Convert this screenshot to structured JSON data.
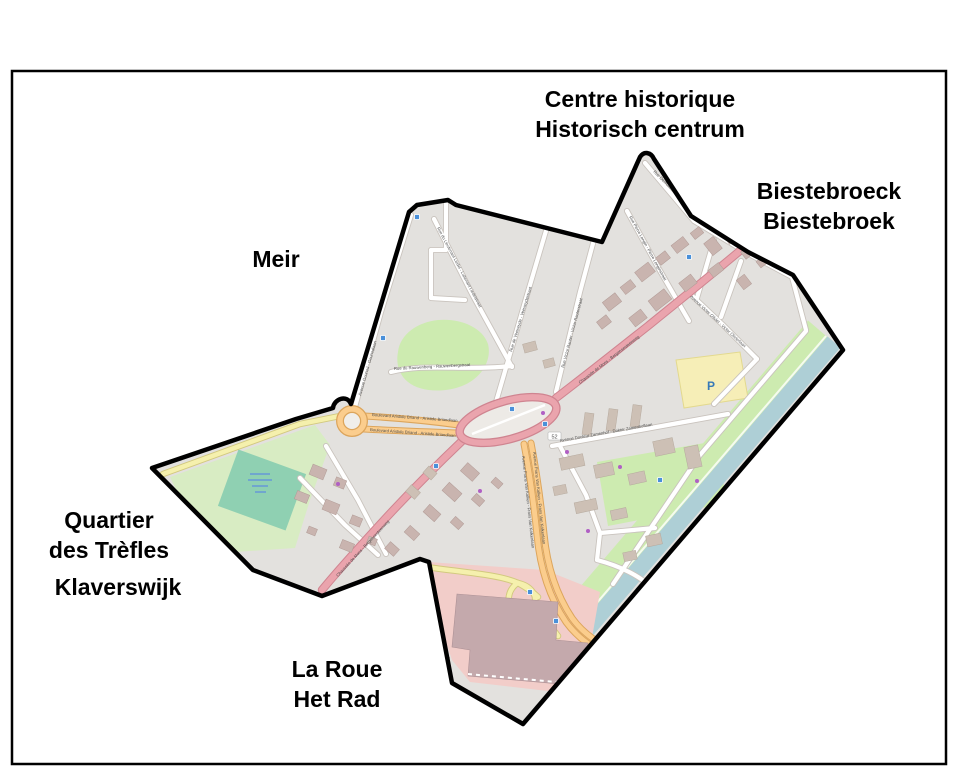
{
  "figure": {
    "type": "district-map",
    "background": "#ffffff",
    "frame_color": "#000000",
    "boundary_color": "#000000"
  },
  "region_labels": {
    "centre_historique": {
      "line1": "Centre historique",
      "line2": "Historisch centrum"
    },
    "biestebroeck": {
      "line1": "Biestebroeck",
      "line2": "Biestebroek"
    },
    "meir": {
      "line1": "Meir"
    },
    "quartier_des_trefles": {
      "line1": "Quartier",
      "line2": "des Trèfles",
      "line3": "Klaverswijk"
    },
    "la_roue": {
      "line1": "La Roue",
      "line2": "Het Rad"
    }
  },
  "street_labels": {
    "briand": "Boulevard Aristide Briand - Aristide Briandlaan",
    "mons": "Chaussée de Mons - Bergensesteenweg",
    "van_kalken": "Avenue Frans Van Kalken - Frans Van Kalkenlaan",
    "gounod": "Avenue Gounod - Gounodlaan",
    "liedel": "Rue du Lieutenant Liedel - Luitenant Liedelstraat",
    "veeweyde": "Rue de Veeweyde - Veeweydestraat",
    "rauter": "Rue Victor Rauter - Victor Rauterstraat",
    "zamenhof": "Avenue Docteur Zamenhof - Dokter Zamenhoflaan",
    "olivier": "Avenue Victor Olivier - Victor Olivierlaan",
    "rauwenberg": "Rue du Rauwenberg - Rauwenbergstraat",
    "longin": "Rue Pierre Longin - Pierre Longinstraat",
    "demosthene": "Rue Démosthène - Demosthenesstraat"
  },
  "map_annotations": {
    "parking_symbol": "P",
    "road_ref": "52"
  },
  "map_colors": {
    "district_fill": "#e3e1de",
    "park": "#cdebb0",
    "pitch": "#8fd0b2",
    "water": "#aecfd6",
    "retail_zone": "#f2cdc9",
    "building": "#c9b4af",
    "road_primary": "#eaa4ad",
    "road_secondary": "#fbcd8d",
    "road_tertiary": "#f5f0ad",
    "road_minor": "#ffffff",
    "parking_fill": "#f6eeb7"
  }
}
